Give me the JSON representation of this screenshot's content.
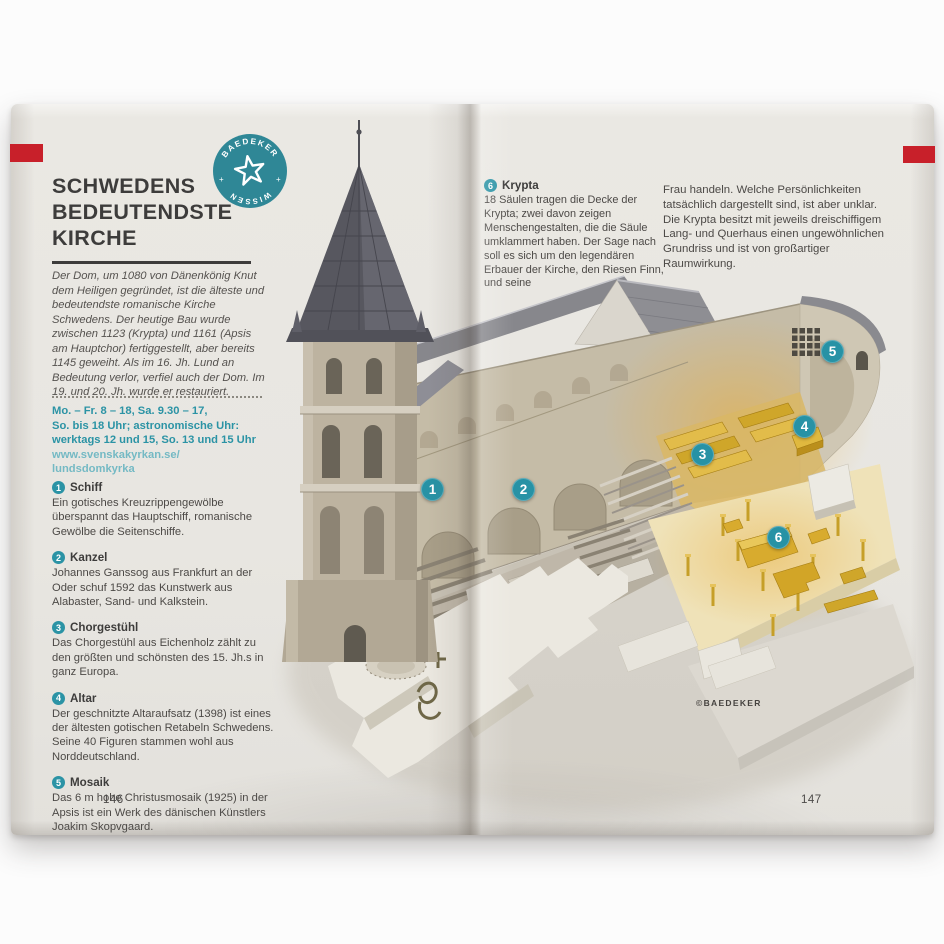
{
  "badge": {
    "top_text": "BAEDEKER",
    "bottom_text": "WISSEN",
    "plus": "+"
  },
  "colors": {
    "accent_teal": "#2b93a5",
    "badge_teal": "#2f8796",
    "tab_red": "#c8202a",
    "gold": "#d9a62e",
    "page": "#e8e6e1"
  },
  "left_page": {
    "title_lines": [
      "SCHWEDENS",
      "BEDEUTENDSTE",
      "KIRCHE"
    ],
    "intro": "Der Dom, um 1080 von Dänenkönig Knut dem Heiligen gegründet, ist die älteste und bedeutendste romanische Kirche Schwedens. Der heutige Bau wurde zwischen 1123 (Krypta) und 1161 (Apsis am Hauptchor) fertiggestellt, aber bereits 1145 geweiht. Als im 16. Jh. Lund an Bedeutung verlor, verfiel auch der Dom. Im 19. und 20. Jh. wurde er restauriert.",
    "hours_lines": [
      "Mo. – Fr. 8 – 18, Sa. 9.30 – 17,",
      "So. bis 18 Uhr; astronomische Uhr:",
      "werktags 12 und 15, So. 13 und 15 Uhr"
    ],
    "url_lines": [
      "www.svenskakyrkan.se/",
      "lundsdomkyrka"
    ],
    "items": [
      {
        "num": "1",
        "title": "Schiff",
        "text": "Ein gotisches Kreuzrippengewölbe überspannt das Hauptschiff, romanische Gewölbe die Seitenschiffe."
      },
      {
        "num": "2",
        "title": "Kanzel",
        "text": "Johannes Ganssog aus Frankfurt an der Oder schuf 1592 das Kunstwerk aus Alabaster, Sand- und Kalkstein."
      },
      {
        "num": "3",
        "title": "Chorgestühl",
        "text": "Das Chorgestühl aus Eichenholz zählt zu den größten und schönsten des 15. Jh.s in ganz Europa."
      },
      {
        "num": "4",
        "title": "Altar",
        "text": "Der geschnitzte Altaraufsatz (1398) ist eines der ältesten gotischen Retabeln Schwedens. Seine 40 Figuren stammen wohl aus Norddeutschland."
      },
      {
        "num": "5",
        "title": "Mosaik",
        "text": "Das 6 m hohe Christusmosaik (1925) in der Apsis ist ein Werk des dänischen Künstlers Joakim Skopvgaard."
      }
    ],
    "page_number": "146"
  },
  "right_page": {
    "krypta_item": {
      "num": "6",
      "title": "Krypta",
      "text": "18 Säulen tragen die Decke der Krypta; zwei davon zeigen Menschengestalten, die die Säule umklammert haben. Der Sage nach soll es sich um den legendären Erbauer der Kirche, den Riesen Finn, und seine"
    },
    "continuation": "Frau handeln. Welche Persönlichkeiten tatsächlich dargestellt sind, ist aber unklar. Die Krypta besitzt mit jeweils dreischiffigem Lang- und Querhaus einen ungewöhnlichen Grundriss und ist von großartiger Raumwirkung.",
    "credit": "©BAEDEKER",
    "page_number": "147"
  },
  "illustration": {
    "subject": "Lund Cathedral cutaway diagram",
    "markers": [
      {
        "num": "1"
      },
      {
        "num": "2"
      },
      {
        "num": "3"
      },
      {
        "num": "4"
      },
      {
        "num": "5"
      },
      {
        "num": "6"
      }
    ]
  }
}
